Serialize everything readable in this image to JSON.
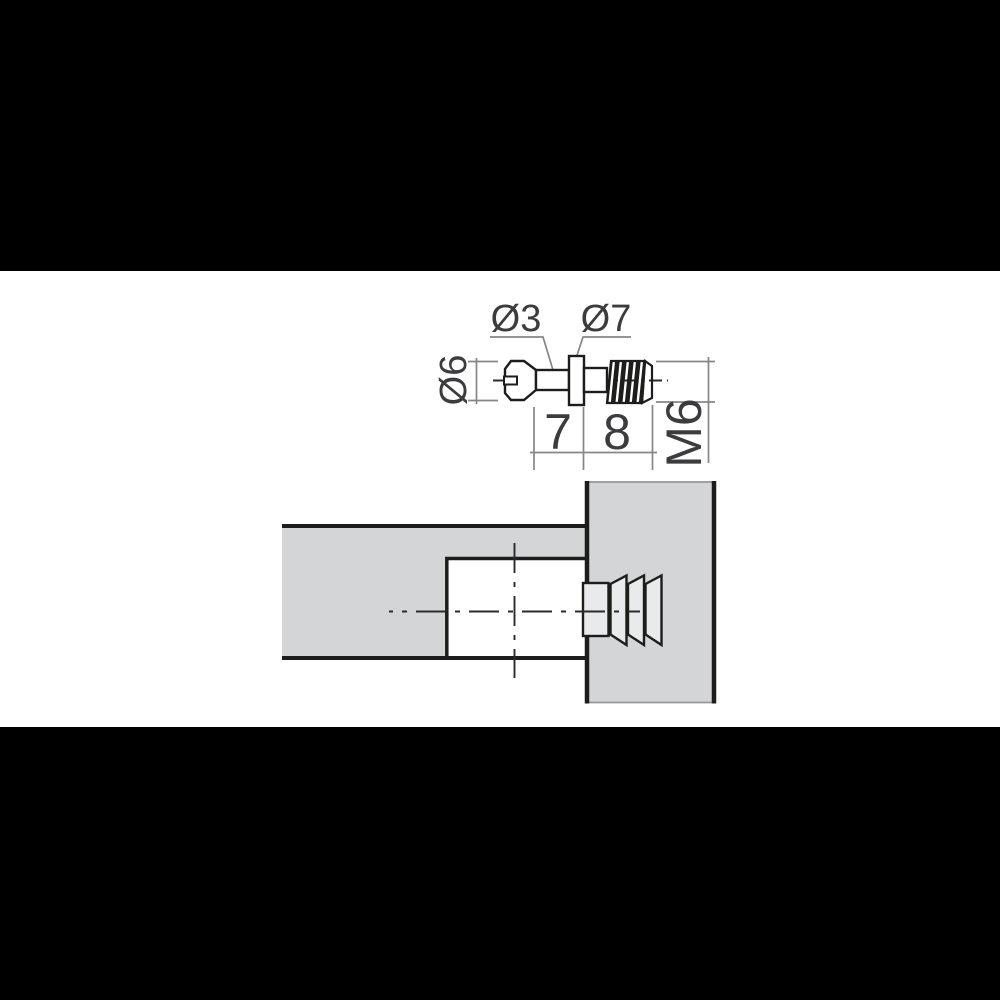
{
  "drawing": {
    "description": "Technical drawing of an M6 furniture connecting bolt (side view with dimensions) and a sectional view of the bolt dowel installed joining a horizontal panel to a vertical panel",
    "labels": {
      "shaft_diameter": "Ø3",
      "collar_diameter": "Ø7",
      "head_diameter": "Ø6",
      "shank_length": "7",
      "thread_length": "8",
      "thread_size": "M6"
    },
    "colors": {
      "background": "#000000",
      "canvas": "#ffffff",
      "outline": "#1d1d1b",
      "panel_fill": "#d3d5d7",
      "part_fill": "#e9eaec",
      "dimension_line": "#85868a",
      "text": "#3c3c3e"
    }
  }
}
